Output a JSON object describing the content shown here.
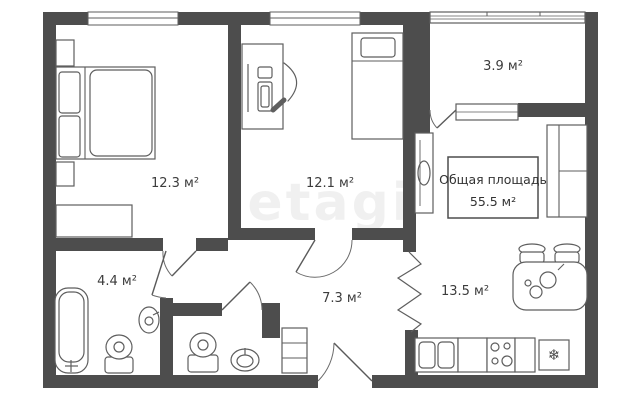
{
  "plan": {
    "watermark": "etagi",
    "total_area_box": {
      "title": "Общая площадь",
      "value": "55.5 м²"
    },
    "rooms": [
      {
        "id": "bedroom-1",
        "area": "12.3 м²"
      },
      {
        "id": "bedroom-2",
        "area": "12.1 м²"
      },
      {
        "id": "balcony",
        "area": "3.9 м²"
      },
      {
        "id": "bathroom",
        "area": "4.4 м²"
      },
      {
        "id": "hallway",
        "area": "7.3 м²"
      },
      {
        "id": "kitchen-living",
        "area": "13.5 м²"
      }
    ],
    "fridge_icon": "❄",
    "colors": {
      "wall": "#4d4d4d",
      "furniture_line": "#5e5e5e",
      "label_text": "#3c3c3c",
      "background": "#ffffff"
    }
  }
}
